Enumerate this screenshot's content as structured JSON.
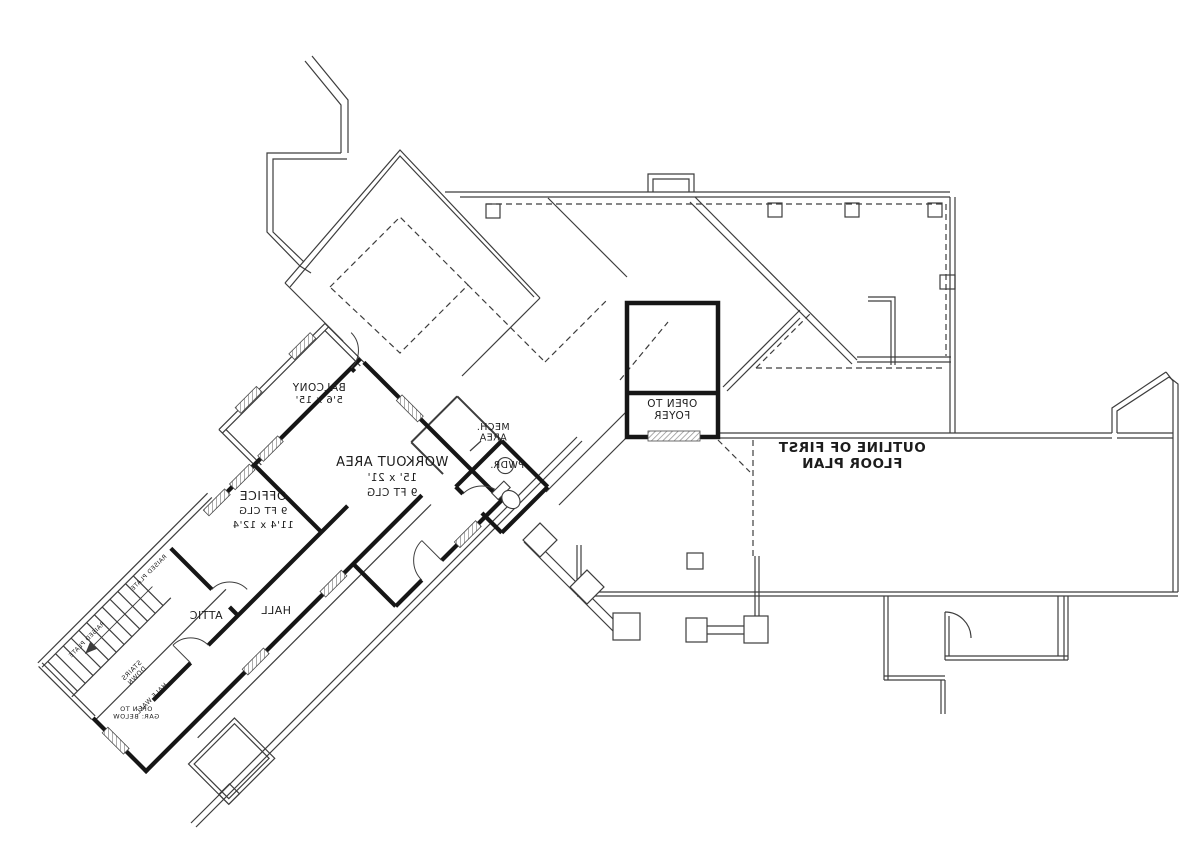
{
  "plan": {
    "colors": {
      "background": "#ffffff",
      "wall_thick": "#161616",
      "line_thin": "#3d3d3d",
      "line_dash": "#4a4a4a",
      "window_hatch": "#8a8a8a"
    },
    "labels": [
      {
        "id": "workout-area",
        "lines": [
          "WORKOUT AREA",
          "15' x 21'",
          "9 FT CLG"
        ],
        "x": 392,
        "y": 466,
        "rotate": 0,
        "size": 13,
        "sub_size": 10.5,
        "bold": false,
        "line_height": 15
      },
      {
        "id": "office",
        "lines": [
          "OFFICE",
          "9 FT CLG",
          "11'4 x 12'4"
        ],
        "x": 263,
        "y": 500,
        "rotate": 0,
        "size": 12.5,
        "sub_size": 10,
        "bold": false,
        "line_height": 14
      },
      {
        "id": "balcony",
        "lines": [
          "BALCONY",
          "5'6 x 15'"
        ],
        "x": 319,
        "y": 391,
        "rotate": 0,
        "size": 10.5,
        "sub_size": 10,
        "bold": false,
        "line_height": 12
      },
      {
        "id": "attic",
        "lines": [
          "ATTIC"
        ],
        "x": 206,
        "y": 619,
        "rotate": 0,
        "size": 11,
        "sub_size": 11,
        "bold": false,
        "line_height": 12
      },
      {
        "id": "hall",
        "lines": [
          "HALL"
        ],
        "x": 276,
        "y": 614,
        "rotate": 0,
        "size": 11,
        "sub_size": 11,
        "bold": false,
        "line_height": 12
      },
      {
        "id": "mech-area",
        "lines": [
          "MECH.",
          "AREA"
        ],
        "x": 493,
        "y": 430,
        "rotate": 0,
        "size": 9.5,
        "sub_size": 9.5,
        "bold": false,
        "line_height": 10.5
      },
      {
        "id": "pwdr",
        "lines": [
          "PWDR."
        ],
        "x": 507,
        "y": 468,
        "rotate": 0,
        "size": 9.5,
        "sub_size": 9.5,
        "bold": false,
        "line_height": 10
      },
      {
        "id": "open-to-foyer",
        "lines": [
          "OPEN TO",
          "FOYER"
        ],
        "x": 672,
        "y": 407,
        "rotate": 0,
        "size": 10.5,
        "sub_size": 10.5,
        "bold": false,
        "line_height": 12
      },
      {
        "id": "outline-first-floor",
        "lines": [
          "OUTLINE OF FIRST",
          "FLOOR PLAN"
        ],
        "x": 852,
        "y": 452,
        "rotate": 0,
        "size": 13.5,
        "sub_size": 13.5,
        "bold": true,
        "line_height": 16
      },
      {
        "id": "stairs-down",
        "lines": [
          "STAIRS",
          "DOWN"
        ],
        "x": 133,
        "y": 672,
        "rotate": -45,
        "size": 6.5,
        "sub_size": 6.5,
        "bold": false,
        "line_height": 7.5
      },
      {
        "id": "half-wall",
        "lines": [
          "HALF WALL"
        ],
        "x": 153,
        "y": 700,
        "rotate": -45,
        "size": 6.5,
        "sub_size": 6.5,
        "bold": false,
        "line_height": 7
      },
      {
        "id": "open-to-gar-below",
        "lines": [
          "OPEN TO",
          "GAR: BELOW"
        ],
        "x": 136,
        "y": 711,
        "rotate": 0,
        "size": 6.5,
        "sub_size": 6.5,
        "bold": false,
        "line_height": 7.5
      },
      {
        "id": "raised-plate-upper",
        "lines": [
          "RAISED PLATE"
        ],
        "x": 150,
        "y": 574,
        "rotate": -45,
        "size": 6,
        "sub_size": 6,
        "bold": false,
        "line_height": 7
      },
      {
        "id": "raised-plate-lower",
        "lines": [
          "RAISED PLATE"
        ],
        "x": 88,
        "y": 641,
        "rotate": -45,
        "size": 6,
        "sub_size": 6,
        "bold": false,
        "line_height": 7
      }
    ]
  }
}
